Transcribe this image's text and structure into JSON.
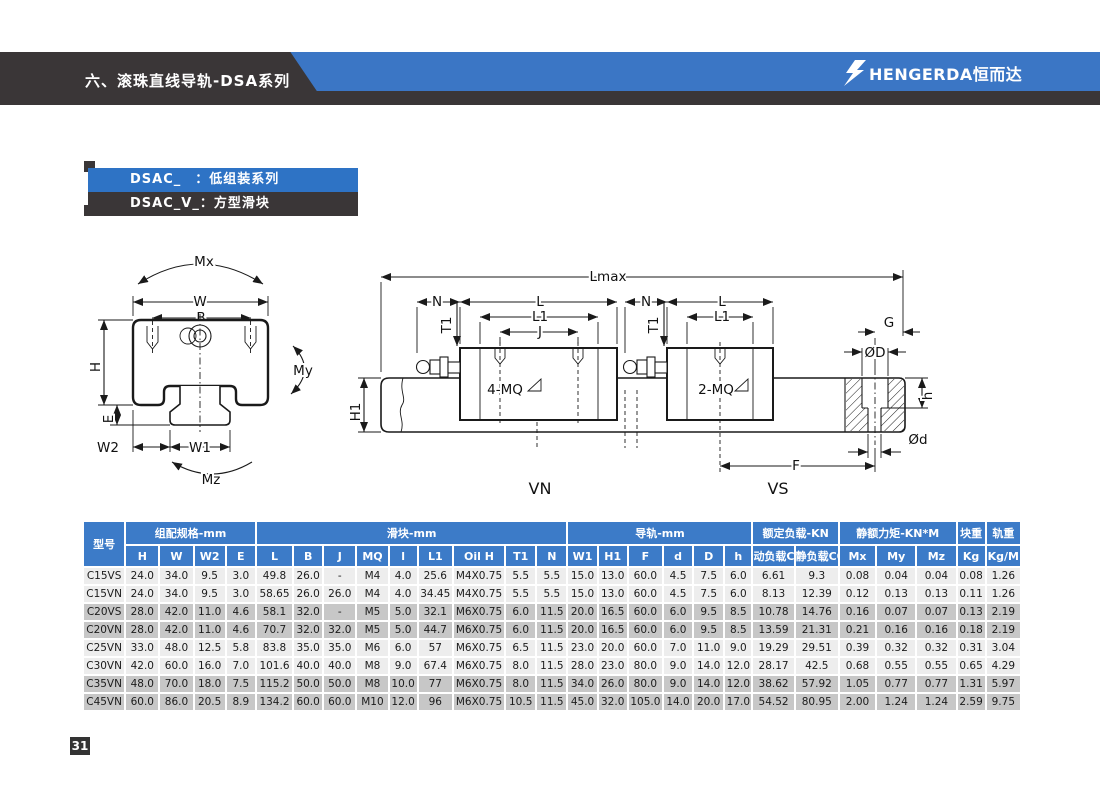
{
  "header": {
    "title": "六、滚珠直线导轨-DSA系列",
    "logo_text": "HENGERDA恒而达"
  },
  "series": [
    {
      "label": "DSAC_　：低组装系列"
    },
    {
      "label": "DSAC_V_：方型滑块"
    }
  ],
  "diagram": {
    "mx": "Mx",
    "my": "My",
    "mz": "Mz",
    "w": "W",
    "b": "B",
    "h": "H",
    "e": "E",
    "w2": "W2",
    "w1": "W1",
    "lmax": "Lmax",
    "n": "N",
    "l": "L",
    "l1": "L1",
    "j": "J",
    "t1": "T1",
    "mq4": "4-MQ",
    "mq2": "2-MQ",
    "g": "G",
    "phi_d_big": "ØD",
    "h_counterbore": "h",
    "phi_d_small": "Ød",
    "f": "F",
    "h1": "H1",
    "vn": "VN",
    "vs": "VS"
  },
  "table": {
    "model_header": "型号",
    "groups": [
      {
        "label": "组配规格-mm",
        "span": 4
      },
      {
        "label": "滑块-mm",
        "span": 9
      },
      {
        "label": "导轨-mm",
        "span": 6
      },
      {
        "label": "额定负载-KN",
        "span": 2
      },
      {
        "label": "静额力矩-KN*M",
        "span": 3
      },
      {
        "label": "块重",
        "span": 1
      },
      {
        "label": "轨重",
        "span": 1
      }
    ],
    "columns": [
      "H",
      "W",
      "W2",
      "E",
      "L",
      "B",
      "J",
      "MQ",
      "l",
      "L1",
      "Oil H",
      "T1",
      "N",
      "W1",
      "H1",
      "F",
      "d",
      "D",
      "h",
      "动负载C",
      "静负载C0",
      "Mx",
      "My",
      "Mz",
      "Kg",
      "Kg/M"
    ],
    "rows": [
      {
        "model": "C15VS",
        "shade": false,
        "values": [
          "24.0",
          "34.0",
          "9.5",
          "3.0",
          "49.8",
          "26.0",
          "-",
          "M4",
          "4.0",
          "25.6",
          "M4X0.75",
          "5.5",
          "5.5",
          "15.0",
          "13.0",
          "60.0",
          "4.5",
          "7.5",
          "6.0",
          "6.61",
          "9.3",
          "0.08",
          "0.04",
          "0.04",
          "0.08",
          "1.26"
        ]
      },
      {
        "model": "C15VN",
        "shade": false,
        "values": [
          "24.0",
          "34.0",
          "9.5",
          "3.0",
          "58.65",
          "26.0",
          "26.0",
          "M4",
          "4.0",
          "34.45",
          "M4X0.75",
          "5.5",
          "5.5",
          "15.0",
          "13.0",
          "60.0",
          "4.5",
          "7.5",
          "6.0",
          "8.13",
          "12.39",
          "0.12",
          "0.13",
          "0.13",
          "0.11",
          "1.26"
        ]
      },
      {
        "model": "C20VS",
        "shade": true,
        "values": [
          "28.0",
          "42.0",
          "11.0",
          "4.6",
          "58.1",
          "32.0",
          "-",
          "M5",
          "5.0",
          "32.1",
          "M6X0.75",
          "6.0",
          "11.5",
          "20.0",
          "16.5",
          "60.0",
          "6.0",
          "9.5",
          "8.5",
          "10.78",
          "14.76",
          "0.16",
          "0.07",
          "0.07",
          "0.13",
          "2.19"
        ]
      },
      {
        "model": "C20VN",
        "shade": true,
        "values": [
          "28.0",
          "42.0",
          "11.0",
          "4.6",
          "70.7",
          "32.0",
          "32.0",
          "M5",
          "5.0",
          "44.7",
          "M6X0.75",
          "6.0",
          "11.5",
          "20.0",
          "16.5",
          "60.0",
          "6.0",
          "9.5",
          "8.5",
          "13.59",
          "21.31",
          "0.21",
          "0.16",
          "0.16",
          "0.18",
          "2.19"
        ]
      },
      {
        "model": "C25VN",
        "shade": false,
        "values": [
          "33.0",
          "48.0",
          "12.5",
          "5.8",
          "83.8",
          "35.0",
          "35.0",
          "M6",
          "6.0",
          "57",
          "M6X0.75",
          "6.5",
          "11.5",
          "23.0",
          "20.0",
          "60.0",
          "7.0",
          "11.0",
          "9.0",
          "19.29",
          "29.51",
          "0.39",
          "0.32",
          "0.32",
          "0.31",
          "3.04"
        ]
      },
      {
        "model": "C30VN",
        "shade": false,
        "values": [
          "42.0",
          "60.0",
          "16.0",
          "7.0",
          "101.6",
          "40.0",
          "40.0",
          "M8",
          "9.0",
          "67.4",
          "M6X0.75",
          "8.0",
          "11.5",
          "28.0",
          "23.0",
          "80.0",
          "9.0",
          "14.0",
          "12.0",
          "28.17",
          "42.5",
          "0.68",
          "0.55",
          "0.55",
          "0.65",
          "4.29"
        ]
      },
      {
        "model": "C35VN",
        "shade": true,
        "values": [
          "48.0",
          "70.0",
          "18.0",
          "7.5",
          "115.2",
          "50.0",
          "50.0",
          "M8",
          "10.0",
          "77",
          "M6X0.75",
          "8.0",
          "11.5",
          "34.0",
          "26.0",
          "80.0",
          "9.0",
          "14.0",
          "12.0",
          "38.62",
          "57.92",
          "1.05",
          "0.77",
          "0.77",
          "1.31",
          "5.97"
        ]
      },
      {
        "model": "C45VN",
        "shade": true,
        "values": [
          "60.0",
          "86.0",
          "20.5",
          "8.9",
          "134.2",
          "60.0",
          "60.0",
          "M10",
          "12.0",
          "96",
          "M6X0.75",
          "10.5",
          "11.5",
          "45.0",
          "32.0",
          "105.0",
          "14.0",
          "20.0",
          "17.0",
          "54.52",
          "80.95",
          "2.00",
          "1.24",
          "1.24",
          "2.59",
          "9.75"
        ]
      }
    ]
  },
  "page_number": "31",
  "colors": {
    "banner_dark": "#3a3637",
    "banner_blue": "#3b76c5",
    "bar_blue": "#2e73c5",
    "table_header_blue": "#3c7bc8",
    "row_light": "#ededed",
    "row_shaded": "#c7c7c7"
  }
}
